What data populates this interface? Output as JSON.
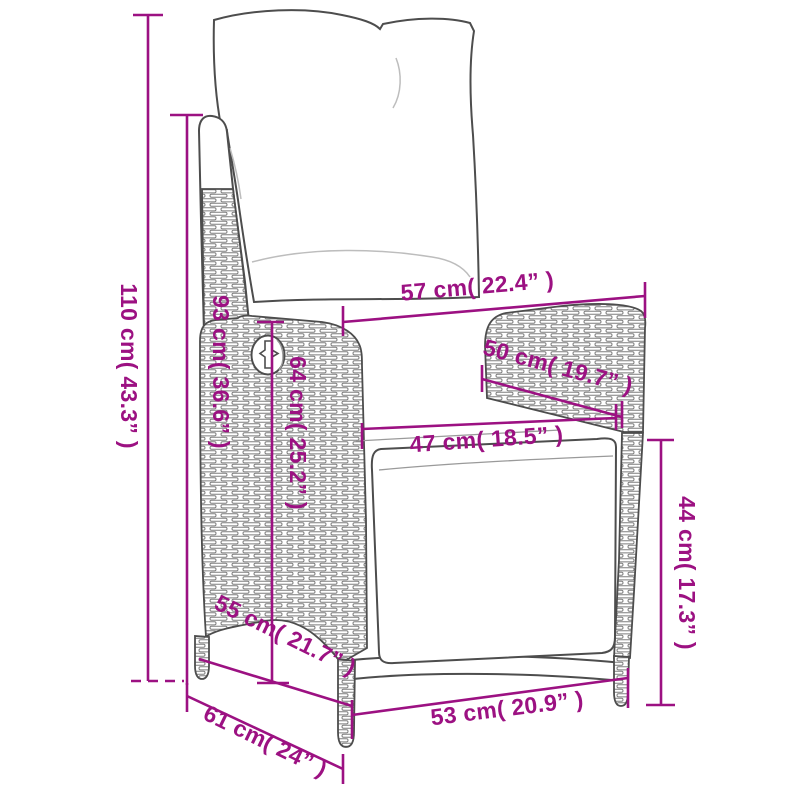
{
  "page": {
    "background": "#ffffff",
    "description": "Product dimension diagram of a poly rattan reclining garden chair with cushions"
  },
  "colors": {
    "dimension_accent": "#9C1182",
    "chair_outline": "#4d4d4d",
    "wicker_weave": "#7d7d7d",
    "cushion_crease": "#bdbdbd"
  },
  "units": {
    "primary": "cm",
    "secondary": "inches"
  },
  "dimensions": [
    {
      "name": "total-height",
      "label": "110 cm( 43.3” )",
      "cm": 110,
      "inches": 43.3,
      "orientation": "vertical"
    },
    {
      "name": "backrest-height",
      "label": "93 cm( 36.6” )",
      "cm": 93,
      "inches": 36.6,
      "orientation": "vertical"
    },
    {
      "name": "top-width",
      "label": "57 cm( 22.4” )",
      "cm": 57,
      "inches": 22.4,
      "orientation": "horizontal"
    },
    {
      "name": "armrest-length",
      "label": "50 cm( 19.7” )",
      "cm": 50,
      "inches": 19.7,
      "orientation": "diagonal"
    },
    {
      "name": "seat-width",
      "label": "47 cm( 18.5” )",
      "cm": 47,
      "inches": 18.5,
      "orientation": "horizontal"
    },
    {
      "name": "side-height",
      "label": "64 cm( 25.2” )",
      "cm": 64,
      "inches": 25.2,
      "orientation": "vertical"
    },
    {
      "name": "seat-height",
      "label": "44 cm( 17.3” )",
      "cm": 44,
      "inches": 17.3,
      "orientation": "vertical"
    },
    {
      "name": "seat-depth",
      "label": "55 cm( 21.7” )",
      "cm": 55,
      "inches": 21.7,
      "orientation": "diagonal"
    },
    {
      "name": "base-depth",
      "label": "61 cm( 24” )",
      "cm": 61,
      "inches": 24,
      "orientation": "diagonal"
    },
    {
      "name": "front-width",
      "label": "53 cm( 20.9” )",
      "cm": 53,
      "inches": 20.9,
      "orientation": "horizontal"
    }
  ]
}
